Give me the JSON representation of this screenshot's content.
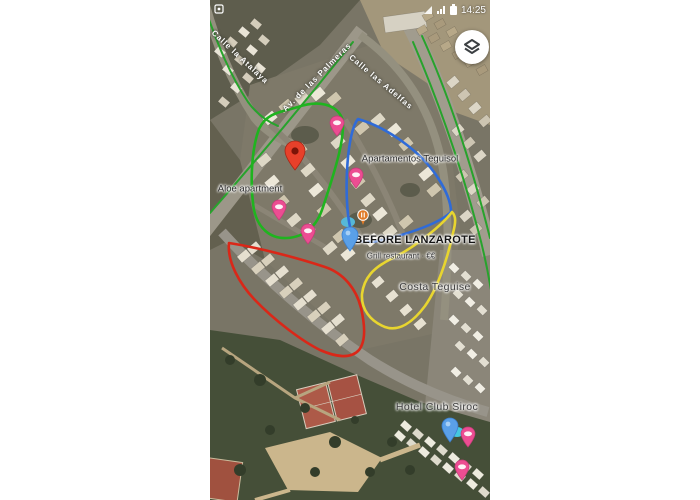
{
  "status_bar": {
    "time": "14:25"
  },
  "icons": {
    "layers": "layers-icon",
    "battery": "battery-icon",
    "signal": "signal-icon",
    "notification": "notification-icon"
  },
  "map": {
    "street_labels": [
      {
        "text": "Calle la Atalaya",
        "x": 30,
        "y": 57,
        "rot": 43
      },
      {
        "text": "Av. de las Palmeras",
        "x": 107,
        "y": 77,
        "rot": -45
      },
      {
        "text": "Calle las Adelfas",
        "x": 171,
        "y": 82,
        "rot": 40
      }
    ],
    "poi_labels": [
      {
        "text": "Aloe apartment",
        "x": 40,
        "y": 189,
        "cls": "poi"
      },
      {
        "text": "Apartamentos Teguisol",
        "x": 200,
        "y": 159,
        "cls": "poi"
      },
      {
        "text": "BEFORE LANZAROTE",
        "x": 205,
        "y": 240,
        "cls": "poi-bold"
      },
      {
        "text": "Grill restaurant · €€",
        "x": 191,
        "y": 256,
        "cls": "poi-sub"
      },
      {
        "text": "Costa Teguise",
        "x": 225,
        "y": 287,
        "cls": "poi-town"
      },
      {
        "text": "Hotel Club Siroc",
        "x": 227,
        "y": 407,
        "cls": "poi-town"
      }
    ],
    "pins": [
      {
        "type": "red-pin",
        "x": 85,
        "y": 172
      },
      {
        "type": "blue-pin",
        "x": 140,
        "y": 252
      },
      {
        "type": "blue-pin",
        "x": 240,
        "y": 443
      },
      {
        "type": "pink-pin",
        "x": 127,
        "y": 137
      },
      {
        "type": "pink-pin",
        "x": 146,
        "y": 189
      },
      {
        "type": "pink-pin",
        "x": 69,
        "y": 221
      },
      {
        "type": "pink-pin",
        "x": 98,
        "y": 245
      },
      {
        "type": "pink-pin",
        "x": 258,
        "y": 448
      },
      {
        "type": "pink-pin",
        "x": 252,
        "y": 481
      },
      {
        "type": "restaurant-poi-pin",
        "x": 153,
        "y": 226
      }
    ],
    "routes": [
      {
        "name": "green-route",
        "color": "#1fb41f",
        "width": 2.6,
        "d": "M88,107 C108,100 126,104 132,118 C136,134 127,165 113,207 C107,226 95,237 77,238 C60,239 48,228 44,210 C40,186 41,150 49,129 C57,112 72,112 88,107 Z"
      },
      {
        "name": "blue-route",
        "color": "#2f6bd8",
        "width": 2.6,
        "d": "M148,119 C176,127 211,151 228,178 C237,192 241,204 241,212 C231,222 206,231 181,238 C163,243 149,244 143,236 C137,223 135,190 138,157 C140,138 143,125 148,119 Z"
      },
      {
        "name": "red-route",
        "color": "#da2718",
        "width": 2.6,
        "d": "M19,243 C45,247 85,257 115,267 C133,273 146,288 151,308 C155,325 156,341 149,350 C141,359 126,357 110,350 C92,341 65,321 44,299 C30,284 17,262 19,243 Z"
      },
      {
        "name": "yellow-route",
        "color": "#e8d52f",
        "width": 2.6,
        "d": "M242,212 C233,224 206,247 181,259 C163,268 154,278 152,294 C151,309 160,321 175,327 C189,332 203,322 215,306 C227,289 237,261 243,233 C246,222 246,216 242,212 Z"
      }
    ],
    "traffic": [
      {
        "name": "traffic-line",
        "color": "#27a32c",
        "width": 2,
        "d": "M-3,14 C8,45 20,75 38,102 C46,113 56,121 68,126"
      },
      {
        "name": "traffic-line",
        "color": "#27a32c",
        "width": 2,
        "d": "M143,42 C100,96 50,156 0,213"
      },
      {
        "name": "traffic-line",
        "color": "#27a32c",
        "width": 2,
        "d": "M203,42 C230,105 252,170 268,230 C274,252 278,272 281,290"
      },
      {
        "name": "traffic-line",
        "color": "#27a32c",
        "width": 2,
        "d": "M212,36 C241,100 263,170 280,238"
      }
    ]
  }
}
